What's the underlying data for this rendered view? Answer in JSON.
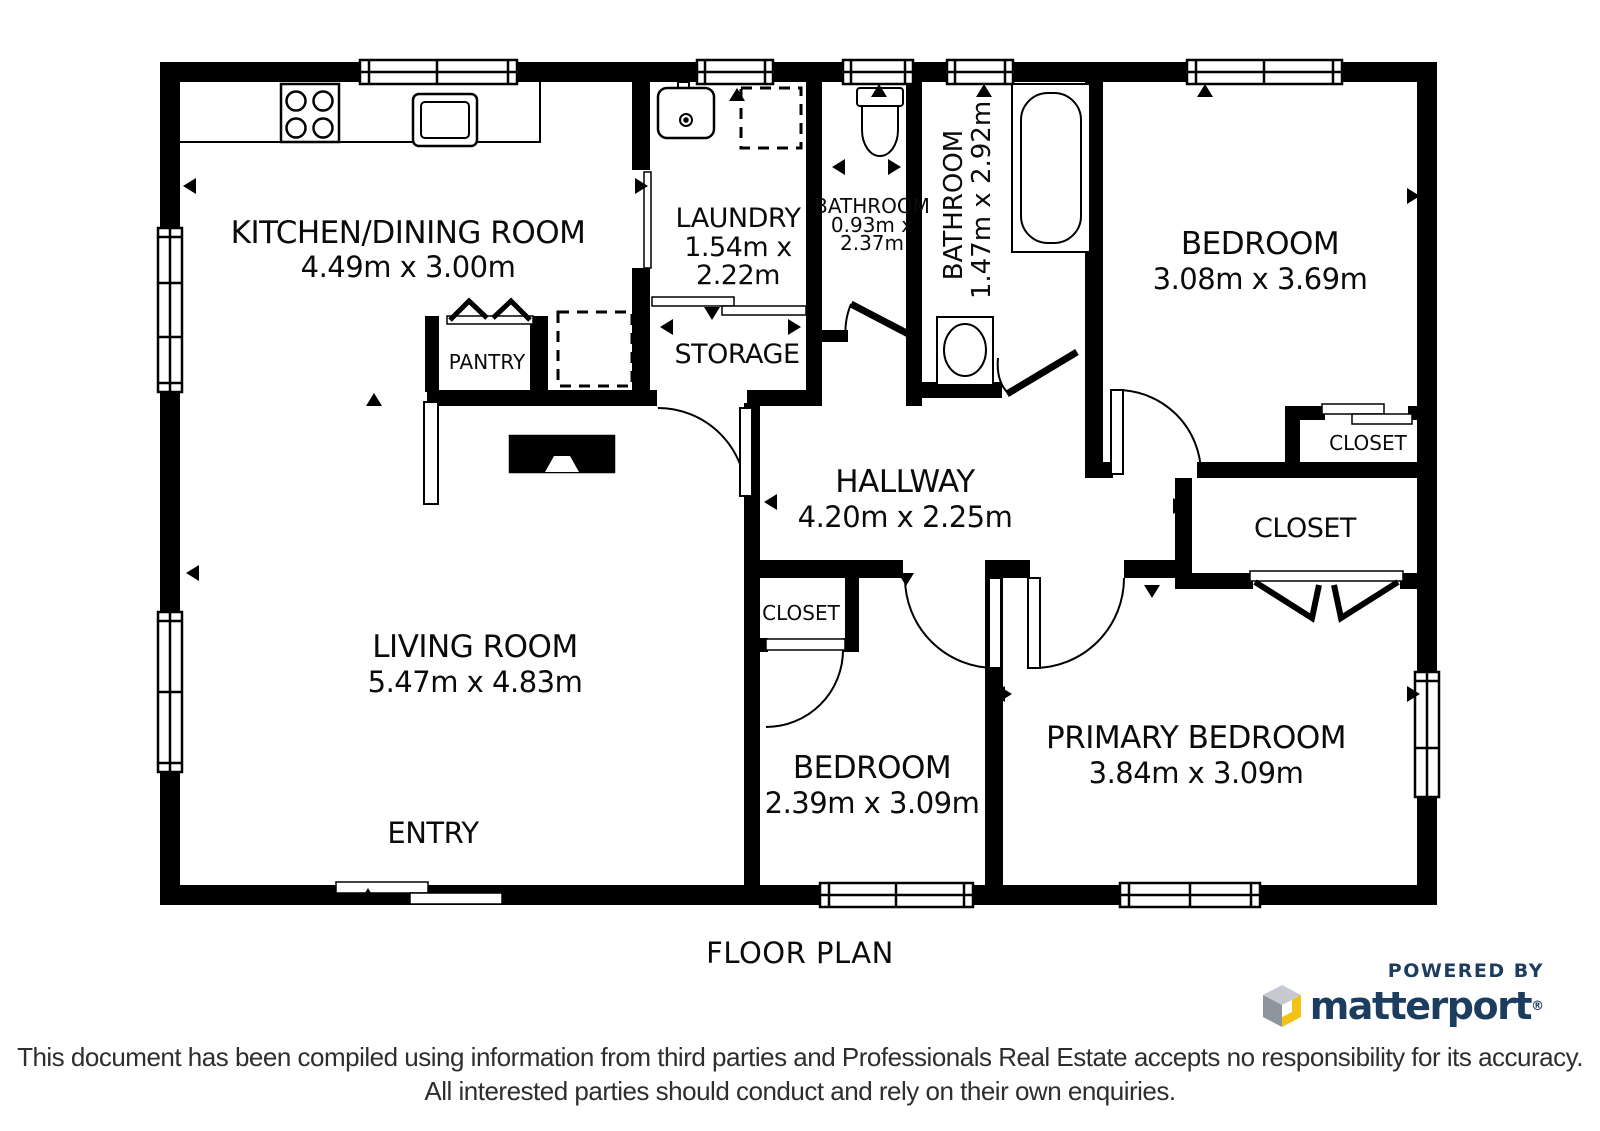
{
  "title": "FLOOR PLAN",
  "rooms": {
    "kitchen": {
      "name": "KITCHEN/DINING ROOM",
      "dims": "4.49m x 3.00m"
    },
    "laundry": {
      "name": "LAUNDRY",
      "dims_line1": "1.54m x",
      "dims_line2": "2.22m"
    },
    "storage": {
      "name": "STORAGE"
    },
    "pantry": {
      "name": "PANTRY"
    },
    "bathroom_small": {
      "name": "BATHROOM",
      "dims_line1": "0.93m x",
      "dims_line2": "2.37m"
    },
    "bathroom_main": {
      "name": "BATHROOM",
      "dims": "1.47m x 2.92m"
    },
    "bedroom_top": {
      "name": "BEDROOM",
      "dims": "3.08m x 3.69m"
    },
    "closet_bedroom_top": {
      "name": "CLOSET"
    },
    "closet_hall": {
      "name": "CLOSET"
    },
    "hallway": {
      "name": "HALLWAY",
      "dims": "4.20m x 2.25m"
    },
    "living": {
      "name": "LIVING ROOM",
      "dims": "5.47m x 4.83m"
    },
    "entry": {
      "name": "ENTRY"
    },
    "closet_bedroom_mid": {
      "name": "CLOSET"
    },
    "bedroom_mid": {
      "name": "BEDROOM",
      "dims": "2.39m x 3.09m"
    },
    "primary": {
      "name": "PRIMARY BEDROOM",
      "dims": "3.84m x 3.09m"
    }
  },
  "branding": {
    "powered_by": "POWERED BY",
    "brand": "matterport",
    "reg": "®"
  },
  "disclaimer": {
    "line1": "This document has been compiled using information from third parties and Professionals Real Estate accepts no responsibility for its accuracy.",
    "line2": "All interested parties should conduct and rely on their own enquiries."
  },
  "colors": {
    "wall": "#000000",
    "background": "#ffffff",
    "matterport_navy": "#1d3d5f",
    "matterport_yellow": "#f2c216",
    "cube_gray_light": "#c6cad0",
    "cube_gray_dark": "#8e949b"
  }
}
